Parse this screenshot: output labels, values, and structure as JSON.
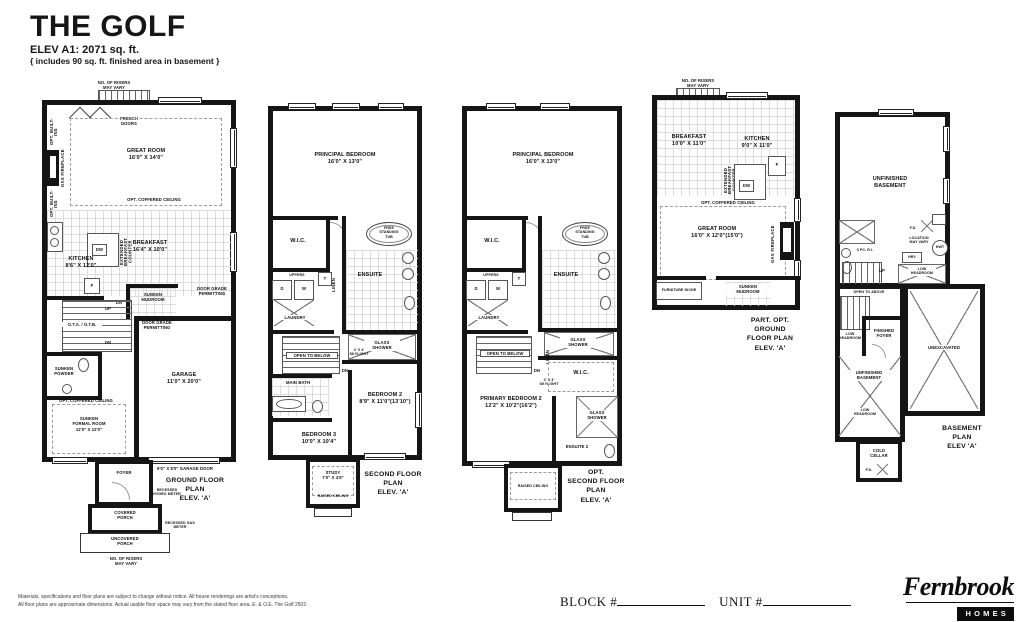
{
  "header": {
    "title": "THE GOLF",
    "elev": "ELEV A1: 2071 sq. ft.",
    "note": "{ includes 90 sq. ft. finished area in basement }"
  },
  "ground": {
    "plan_label": [
      "GROUND FLOOR PLAN",
      "ELEV. 'A'"
    ],
    "risers_top": [
      "NO. OF RISERS",
      "MAY VARY"
    ],
    "french_doors": [
      "FRENCH",
      "DOORS"
    ],
    "opt_builtins_a": "OPT. BUILT-INS",
    "gas_fireplace": "GAS FIREPLACE",
    "opt_builtins_b": "OPT. BUILT-INS",
    "great_room": [
      "GREAT ROOM",
      "16'0\" X 14'0\""
    ],
    "coffered_a": "OPT. COFFERED CEILING",
    "dw": "DW",
    "ext_counter": "EXTENDED BREAKFAST COUNTER",
    "breakfast": [
      "BREAKFAST",
      "16'4\" X 10'0\""
    ],
    "kitchen": [
      "KITCHEN",
      "8'6\" X 12'0\""
    ],
    "fridge": "F",
    "mudroom": [
      "SUNKEN",
      "MUDROOM"
    ],
    "dn_a": "DN",
    "door_grade_a": [
      "DOOR GRADE",
      "PERMITTING"
    ],
    "door_grade_b": [
      "DOOR GRADE",
      "PERMITTING"
    ],
    "ota": "O.T.A. / O.T.B.",
    "up": "UP",
    "dn_b": "DN",
    "powder": [
      "SUNKEN",
      "POWDER"
    ],
    "garage": [
      "GARAGE",
      "11'0\" X 20'0\""
    ],
    "coffered_b": "OPT. COFFERED CEILING",
    "formal": [
      "SUNKEN",
      "FORMAL ROOM",
      "12'0\" X 12'0\""
    ],
    "garage_door": "9'0\" X 8'0\" GARAGE DOOR",
    "foyer": "FOYER",
    "hydro": [
      "RECESSED",
      "HYDRO METER"
    ],
    "covered_porch": [
      "COVERED",
      "PORCH"
    ],
    "gas_meter": [
      "RECESSED GAS",
      "METER"
    ],
    "uncovered_porch": [
      "UNCOVERED",
      "PORCH"
    ],
    "risers_bottom": [
      "NO. OF RISERS",
      "MAY VARY"
    ]
  },
  "second": {
    "plan_label": [
      "SECOND FLOOR PLAN",
      "ELEV. 'A'"
    ],
    "principal": [
      "PRINCIPAL BEDROOM",
      "16'0\" X 13'0\""
    ],
    "wic": "W.I.C.",
    "tub": [
      "FREE",
      "STANDING",
      "TUB"
    ],
    "uppers": "UPPERS",
    "d": "D",
    "w": "W",
    "t": "T",
    "laundry": "LAUNDRY",
    "ensuite": "ENSUITE",
    "linen": "LINEN",
    "open_below": "OPEN TO BELOW",
    "dn": "DN",
    "skylight": [
      "4' X 4'",
      "SKYLIGHT"
    ],
    "glass_shower": [
      "GLASS",
      "SHOWER"
    ],
    "main_bath": "MAIN BATH",
    "bedroom2": [
      "BEDROOM 2",
      "8'9\" X 11'0\"(13'10\")"
    ],
    "bedroom3": [
      "BEDROOM 3",
      "10'0\" X 10'4\""
    ],
    "study": [
      "STUDY",
      "7'0\" X 4'6\""
    ],
    "raised_ceiling": "RAISED CEILING"
  },
  "opt_second": {
    "plan_label": [
      "OPT.",
      "SECOND FLOOR PLAN",
      "ELEV. 'A'"
    ],
    "principal": [
      "PRINCIPAL BEDROOM",
      "16'0\" X 13'0\""
    ],
    "wic": "W.I.C.",
    "tub": [
      "FREE",
      "STANDING",
      "TUB"
    ],
    "uppers": "UPPERS",
    "d": "D",
    "w": "W",
    "t": "T",
    "laundry": "LAUNDRY",
    "ensuite": "ENSUITE",
    "open_below": "OPEN TO BELOW",
    "dn": "DN",
    "skylight": [
      "4' X 4'",
      "SKYLIGHT"
    ],
    "glass_shower_a": [
      "GLASS",
      "SHOWER"
    ],
    "linen": "LINEN",
    "wic2": "W.I.C.",
    "primary2": [
      "PRIMARY BEDROOM 2",
      "12'2\" X 10'2\"(16'2\")"
    ],
    "glass_shower_b": [
      "GLASS",
      "SHOWER"
    ],
    "ensuite2": "ENSUITE 2",
    "raised_ceiling": "RAISED CEILING"
  },
  "part_ground": {
    "plan_label": [
      "PART. OPT. GROUND",
      "FLOOR PLAN",
      "ELEV. 'A'"
    ],
    "risers": [
      "NO. OF RISERS",
      "MAY VARY"
    ],
    "breakfast": [
      "BREAKFAST",
      "10'0\" X 11'0\""
    ],
    "kitchen": [
      "KITCHEN",
      "9'0\" X 11'0\""
    ],
    "ext_counter": "EXTENDED BREAKFAST COUNTER",
    "dw": "DW",
    "fridge": "F",
    "coffered": "OPT. COFFERED CEILING",
    "great_room": [
      "GREAT ROOM",
      "16'0\" X 12'0\"(15'0\")"
    ],
    "gas_fireplace": "GAS FIREPLACE",
    "furniture_niche": "FURNITURE NICHE",
    "mudroom": [
      "SUNKEN",
      "MUDROOM"
    ]
  },
  "basement": {
    "plan_label": [
      "BASEMENT PLAN",
      "ELEV 'A'"
    ],
    "unfinished_a": [
      "UNFINISHED",
      "BASEMENT"
    ],
    "three_pc": "3 PC. R.I.",
    "fd_a": "F.D.",
    "location": [
      "LOCATION",
      "MAY VARY"
    ],
    "hwt": "HWT",
    "hrv": "HRV",
    "low_headroom_a": [
      "LOW",
      "HEADROOM"
    ],
    "up": "UP",
    "open_above": "OPEN TO ABOVE",
    "low_headroom_b": [
      "LOW",
      "HEADROOM"
    ],
    "finished_foyer": [
      "FINISHED",
      "FOYER"
    ],
    "unexcavated": "UNEXCAVATED",
    "unfinished_b": [
      "UNFINISHED",
      "BASEMENT"
    ],
    "low_headroom_c": [
      "LOW",
      "HEADROOM"
    ],
    "cold_cellar": [
      "COLD",
      "CELLAR"
    ],
    "fd_b": "F.D."
  },
  "footer": {
    "disclaimer": [
      "Materials, specifications and floor plans are subject to change without notice. All house renderings are artist's conceptions.",
      "All floor plans are approximate dimensions. Actual usable floor space may vary from the stated floor area. E. & O.E. The Golf 2502"
    ],
    "block_label": "BLOCK #",
    "unit_label": "UNIT #"
  },
  "logo": {
    "brand": "Fernbrook",
    "homes": "HOMES"
  },
  "colors": {
    "wall": "#151515",
    "grid": "#dcdcdc",
    "dash": "#9a9a9a"
  }
}
